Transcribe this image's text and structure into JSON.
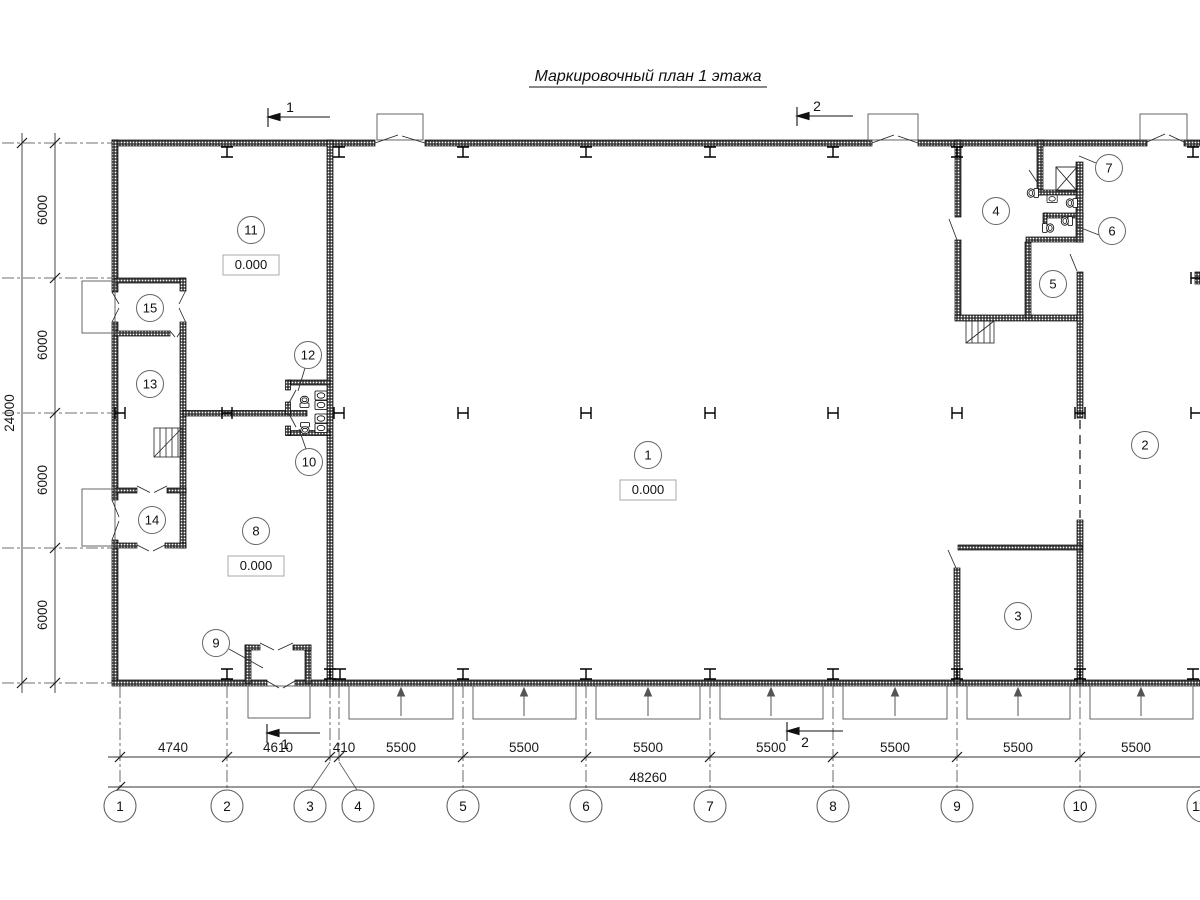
{
  "title": "Маркировочный план 1 этажа",
  "dims": {
    "bottom": [
      "4740",
      "4610",
      "410",
      "5500",
      "5500",
      "5500",
      "5500",
      "5500",
      "5500",
      "5500"
    ],
    "bottom_total": "48260",
    "left": [
      "6000",
      "6000",
      "6000",
      "6000"
    ],
    "left_total": "24000"
  },
  "grid": {
    "cols": [
      "1",
      "2",
      "3",
      "4",
      "5",
      "6",
      "7",
      "8",
      "9",
      "10",
      "11"
    ]
  },
  "rooms": {
    "n1": "1",
    "n2": "2",
    "n3": "3",
    "n4": "4",
    "n5": "5",
    "n6": "6",
    "n7": "7",
    "n8": "8",
    "n9": "9",
    "n10": "10",
    "n11": "11",
    "n12": "12",
    "n13": "13",
    "n14": "14",
    "n15": "15"
  },
  "elevations": {
    "hall": "0.000",
    "room8": "0.000",
    "room11": "0.000"
  },
  "sections": {
    "cut1": "1",
    "cut2": "2"
  }
}
